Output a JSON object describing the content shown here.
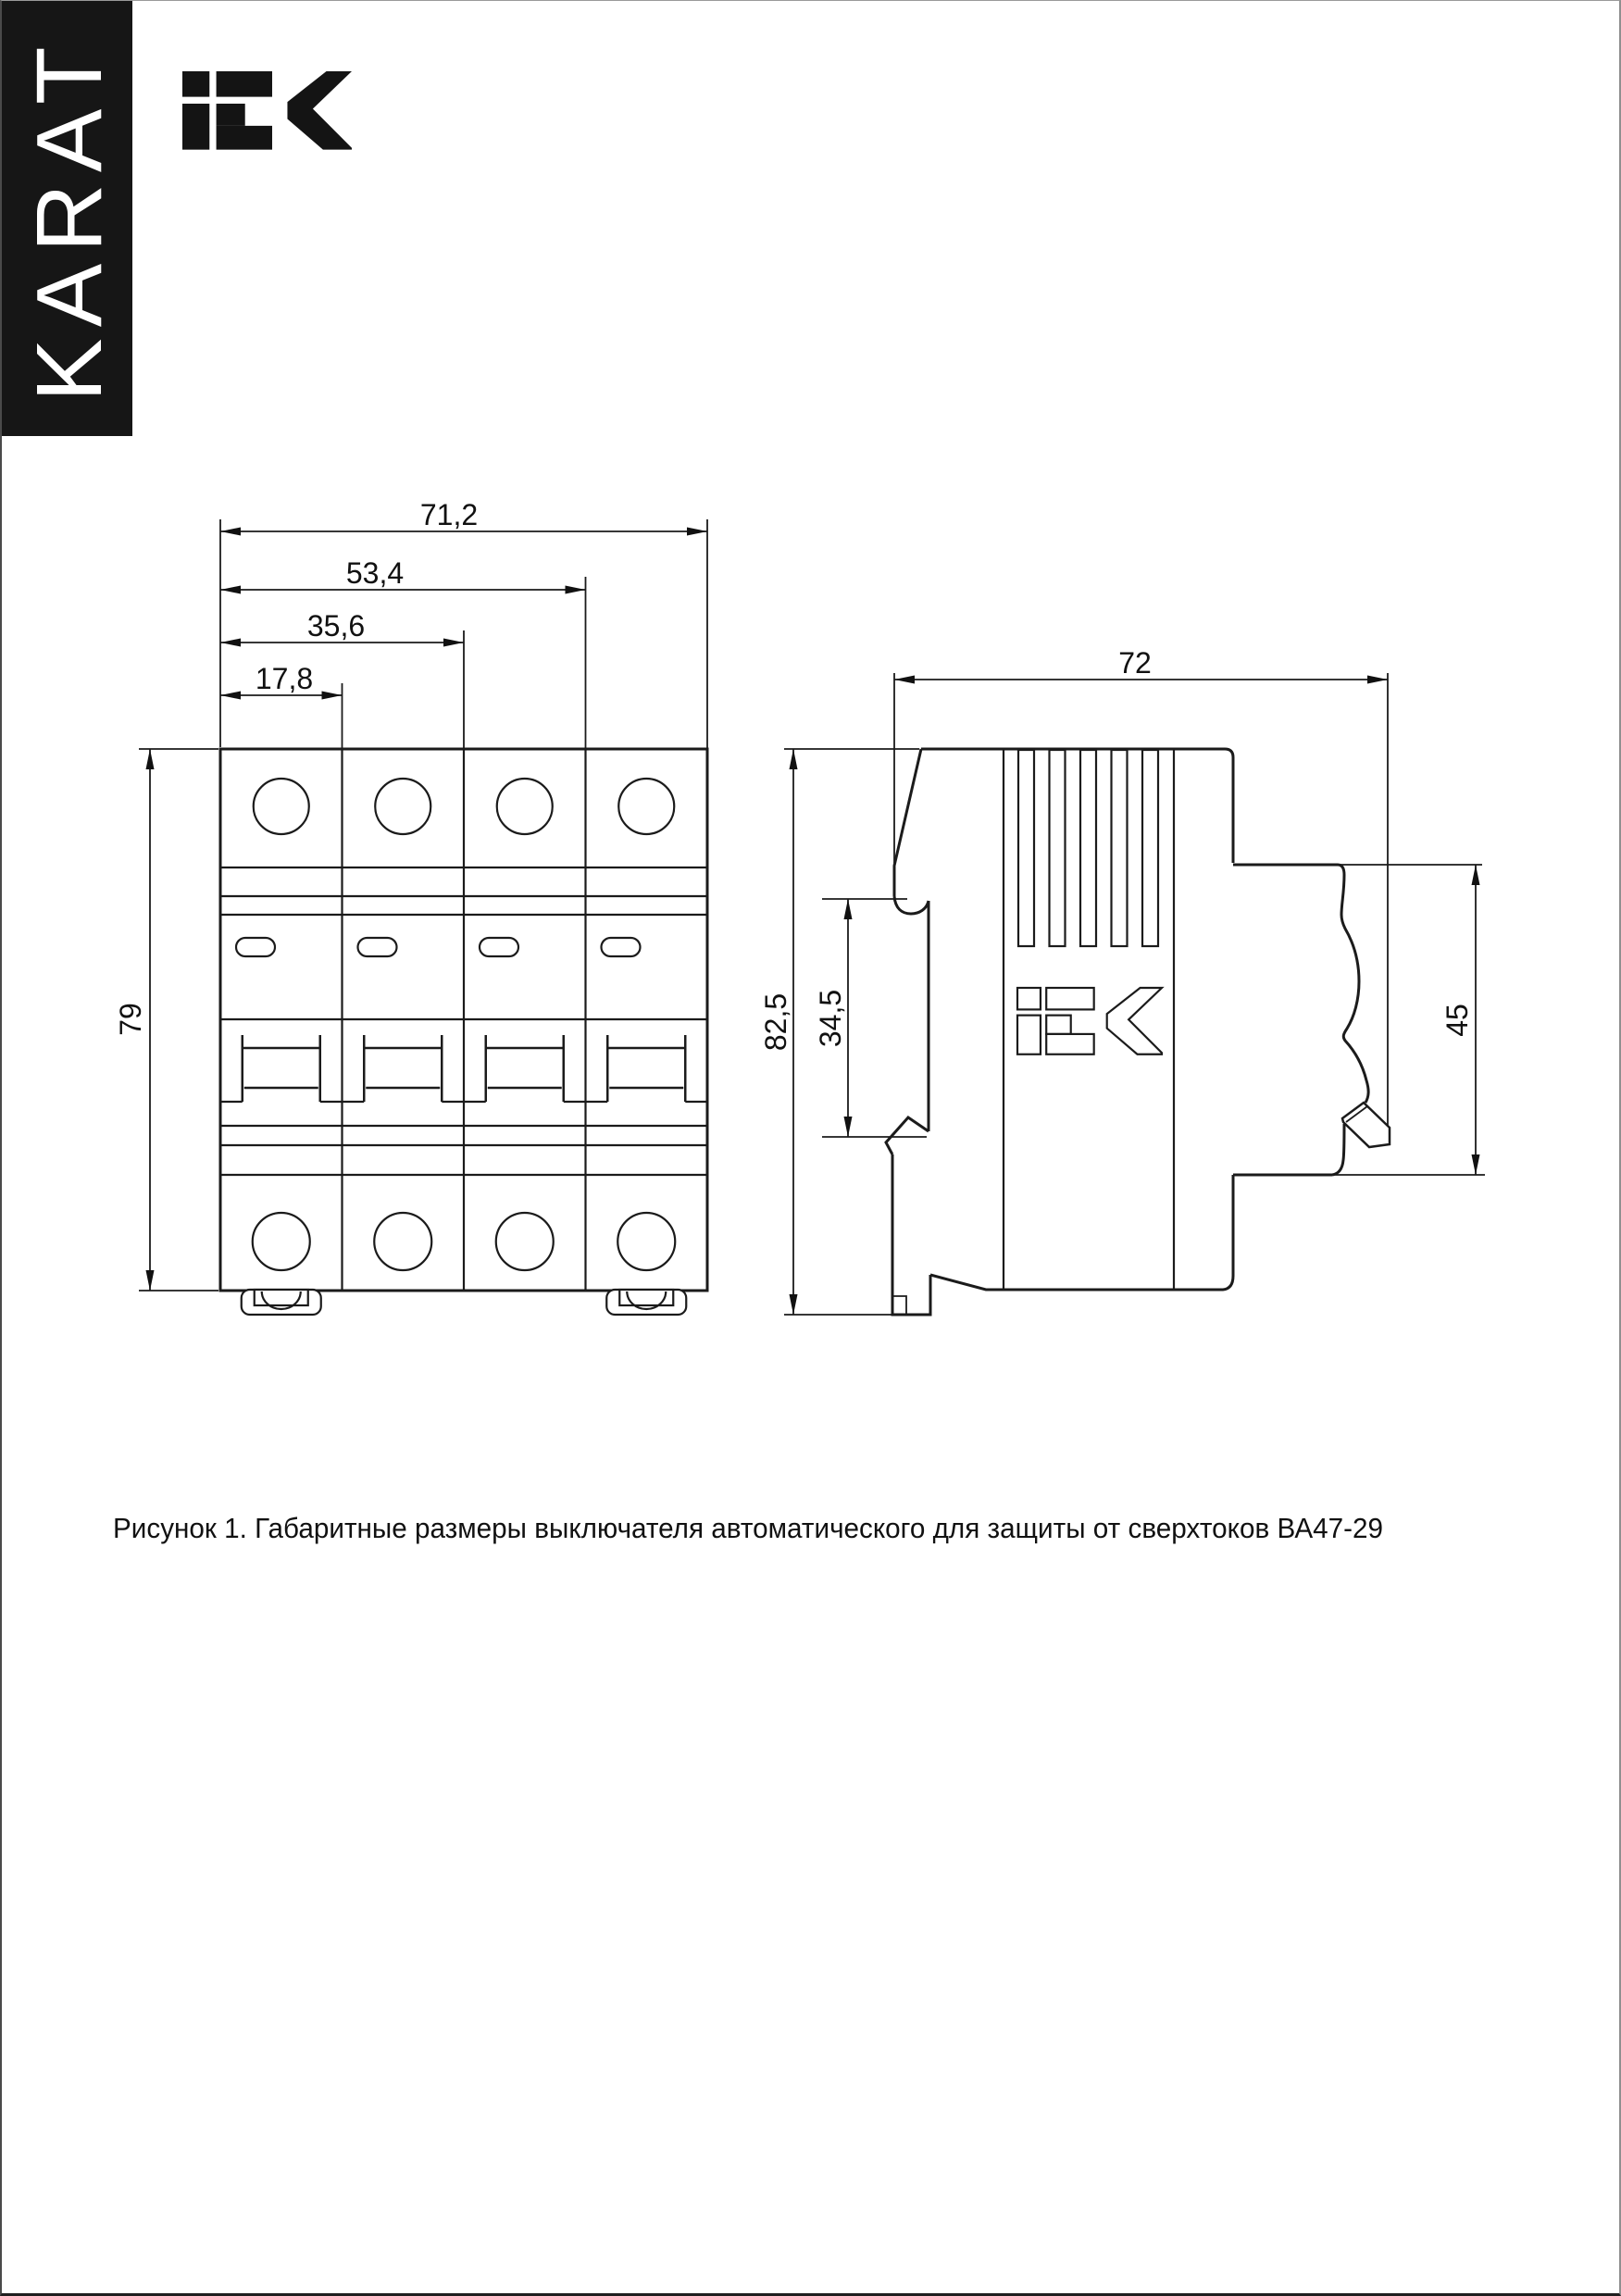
{
  "sidebar": {
    "label": "KARAT"
  },
  "header": {
    "iek_logo": "IEK"
  },
  "front_view": {
    "width_total": "71,2",
    "width_three_modules": "53,4",
    "width_two_modules": "35,6",
    "width_one_module": "17,8",
    "height": "79"
  },
  "side_view": {
    "depth": "72",
    "height_with_clip": "82,5",
    "din_groove_height": "34,5",
    "front_section_height": "45",
    "iek_logo": "IEK"
  },
  "caption": {
    "text": "Рисунок 1. Габаритные размеры выключателя автоматического для защиты от сверхтоков ВА47-29"
  },
  "colors": {
    "line": "#1b1b1b",
    "brand_bar_bg": "#161616",
    "brand_text": "#ffffff",
    "page_border": "#8f8f8f"
  }
}
